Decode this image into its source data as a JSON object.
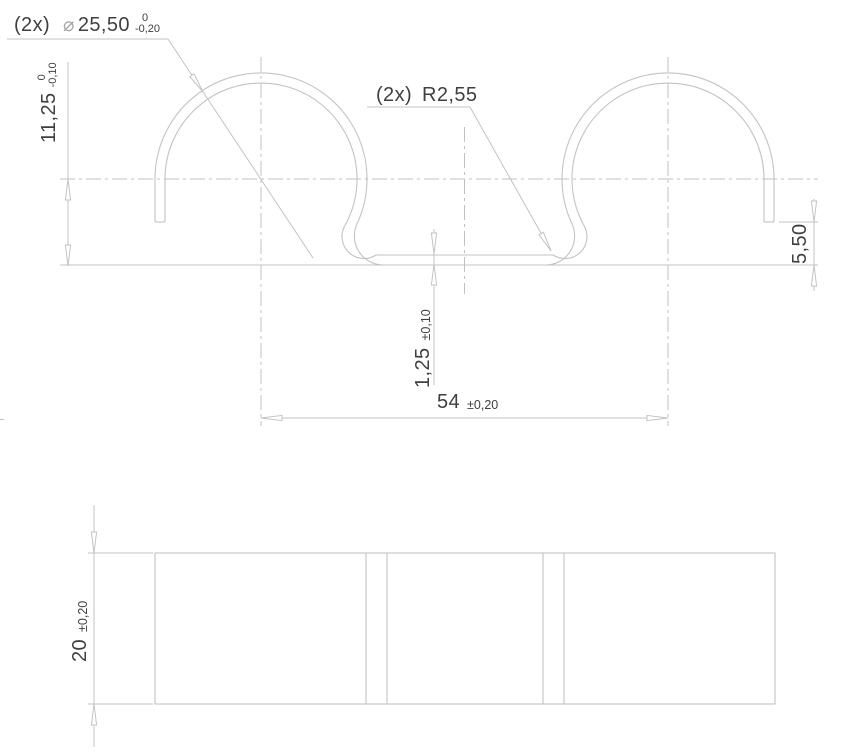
{
  "drawing": {
    "type": "engineering-drawing",
    "dims": {
      "diameter": {
        "prefix": "(2x)",
        "symbol": "⌀",
        "value": "25,50",
        "tol_upper": "0",
        "tol_lower": "-0,20"
      },
      "radius": {
        "prefix": "(2x)",
        "value": "R2,55"
      },
      "height": {
        "value": "11,25",
        "tol_upper": "0",
        "tol_lower": "-0,10"
      },
      "thickness": {
        "value": "1,25",
        "tol": "±0,10"
      },
      "span": {
        "value": "54",
        "tol": "±0,20"
      },
      "leg": {
        "value": "5,50"
      },
      "width": {
        "value": "20",
        "tol": "±0,20"
      }
    },
    "colors": {
      "line": "#c3c3c3",
      "text": "#3f3f3f",
      "symbol": "#a6a6a6"
    }
  }
}
